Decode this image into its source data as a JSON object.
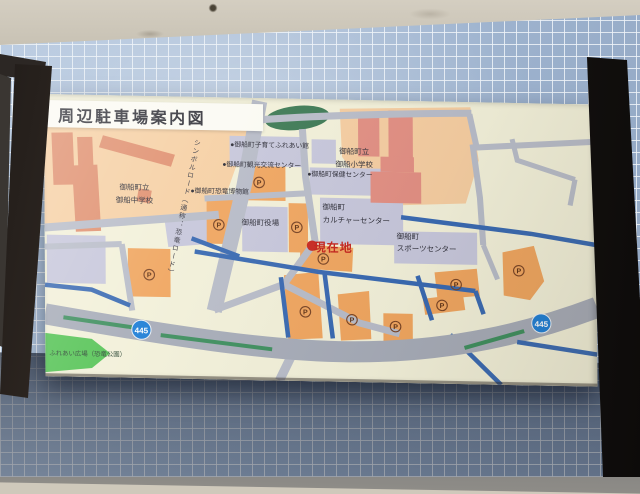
{
  "sign": {
    "title": "周辺駐車場案内図",
    "map": {
      "areas": {
        "junior_high_school": "御船町立\n御船中学校",
        "elementary_school": "御船町立\n御船小学校",
        "culture_center": "御船町\nカルチャーセンター",
        "sports_center": "御船町\nスポーツセンター",
        "town_hall": "御船町役場",
        "fureai_plaza": "ふれあい広場（恐竜公園）"
      },
      "facilities": [
        "●御船町子育てふれあい館",
        "●御船町観光交流センター",
        "●御船町保健センター",
        "●御船町恐竜博物館"
      ],
      "symbol_road_label": "シンボルロード（通称：恐竜ロード）",
      "current_location": "現在地",
      "route_number": "445",
      "parking_symbol": "P"
    },
    "colors": {
      "map_background": "#f2f0d9",
      "school_ground_peach": "#f6d0a4",
      "building_salmon": "#e0906f",
      "building_pink": "#e28f83",
      "public_block_lavender": "#c7c7db",
      "parking_lot_orange": "#f0a660",
      "road_gray": "#b8bcc8",
      "route445_gray": "#a7acb8",
      "median_green": "#3f8f5f",
      "river_blue": "#3a6ab2",
      "park_green": "#57c457",
      "route_shield_blue": "#1f7fd6",
      "current_location_red": "#c92a22",
      "tile_wall_blue": "#a9bed8",
      "post_brown": "#43382f"
    }
  }
}
